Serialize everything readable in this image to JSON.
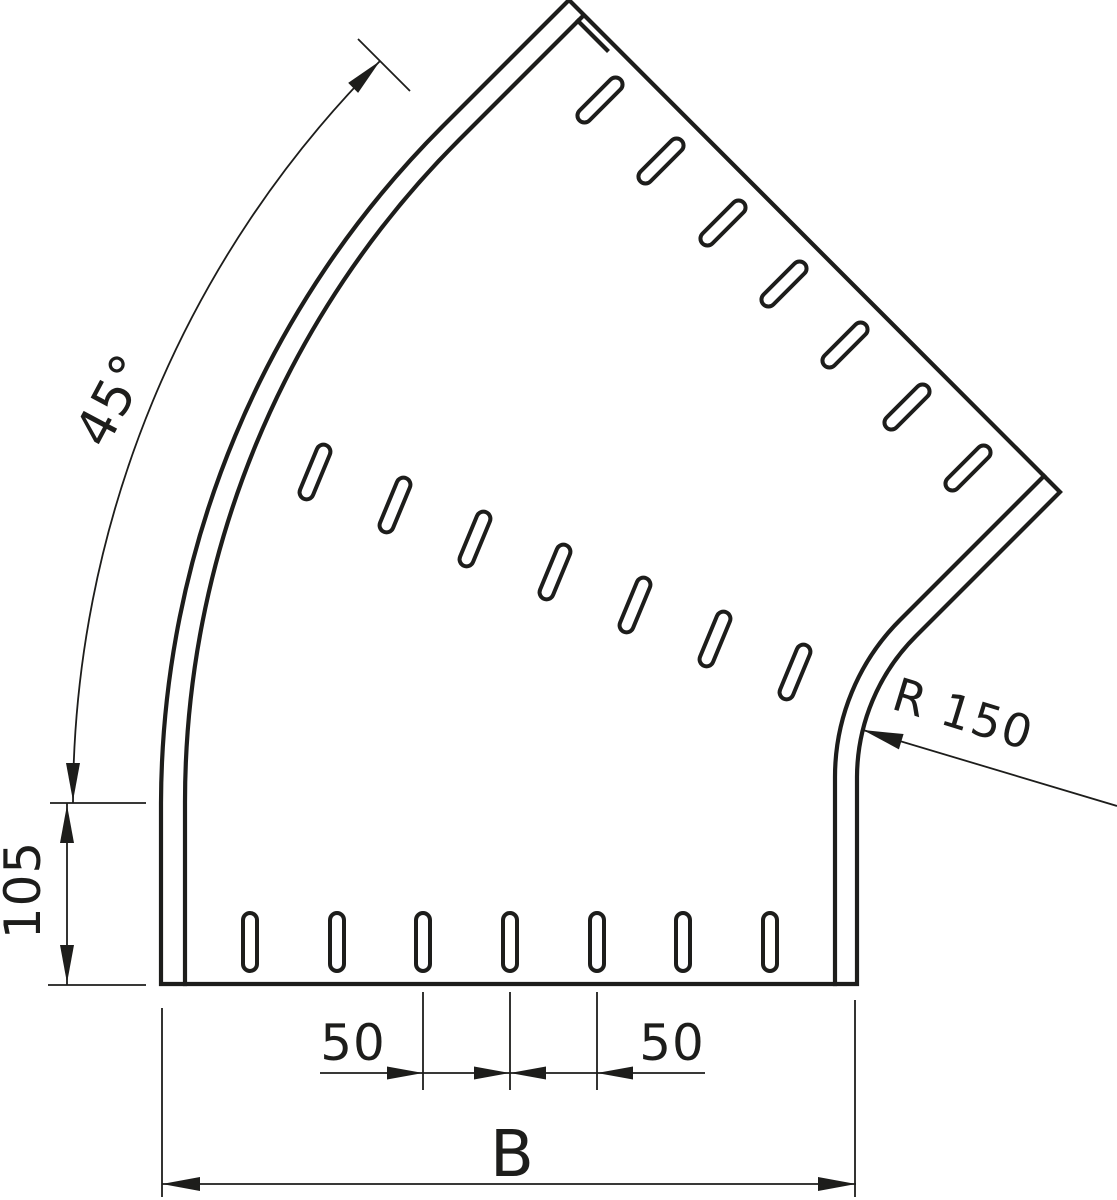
{
  "drawing": {
    "type": "technical-dimension-drawing",
    "subject": "45-degree flat bend of a perforated cable tray, top view",
    "labels": {
      "angle": "45°",
      "height": "105",
      "pitch_left": "50",
      "pitch_right": "50",
      "width": "B",
      "radius": "R 150"
    },
    "colors": {
      "line": "#1d1d1b",
      "background": "#ffffff"
    }
  }
}
